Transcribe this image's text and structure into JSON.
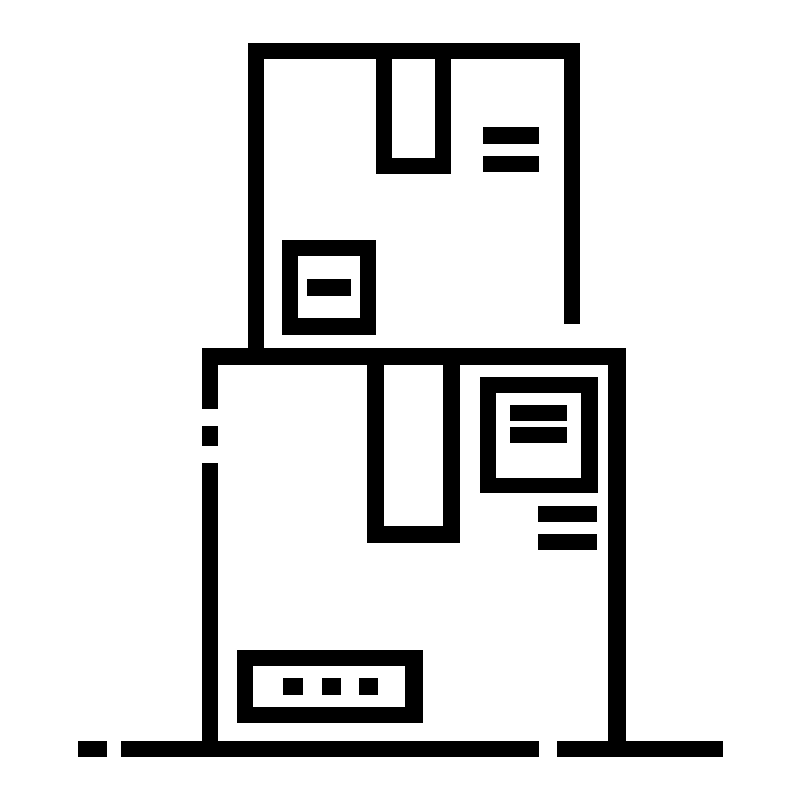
{
  "icon": {
    "name": "stacked-delivery-boxes-icon",
    "description": "Outline pictogram of two stacked cardboard parcel boxes: a smaller sealed box on top of a larger sealed box, each with packing-tape flaps and shipping labels, resting on a dashed ground line",
    "stroke_color": "#000000",
    "background_color": "#ffffff",
    "style": "pixel-crisp outline glyph, ~16px stroke, dashed accents",
    "elements": [
      "top-box-outline",
      "top-box-tape-flap",
      "top-box-equals-mark",
      "top-box-label-badge",
      "bottom-box-outline",
      "bottom-box-tape-flap",
      "bottom-box-label-badge",
      "bottom-box-side-lines",
      "bottom-box-address-strip",
      "ground-line"
    ]
  }
}
